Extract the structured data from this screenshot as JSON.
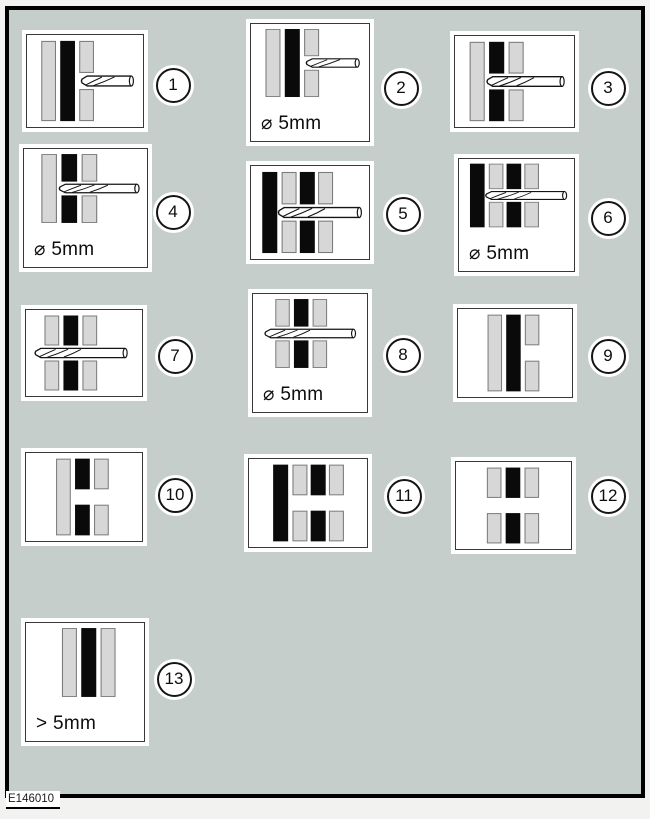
{
  "figure": {
    "code": "E146010"
  },
  "colors": {
    "background": "#c6cecb",
    "frame": "#000000",
    "panel_bg": "#ffffff",
    "bar_gray": "#d7d7d7",
    "bar_gray_outline": "#7c7c7c",
    "bar_black": "#0a0a0a",
    "line": "#141414"
  },
  "panels": [
    {
      "number": "1",
      "label": "",
      "bars": [
        {
          "tone": "gray",
          "split": false
        },
        {
          "tone": "black",
          "split": false
        },
        {
          "tone": "gray",
          "split": true
        }
      ],
      "drill": "into-outer-sheet"
    },
    {
      "number": "2",
      "label": "⌀ 5mm",
      "bars": [
        {
          "tone": "gray",
          "split": false
        },
        {
          "tone": "black",
          "split": false
        },
        {
          "tone": "gray",
          "split": true
        }
      ],
      "drill": "into-outer-sheet"
    },
    {
      "number": "3",
      "label": "",
      "bars": [
        {
          "tone": "gray",
          "split": false
        },
        {
          "tone": "black",
          "split": true
        },
        {
          "tone": "gray",
          "split": true
        }
      ],
      "drill": "through-two-sheets"
    },
    {
      "number": "4",
      "label": "⌀ 5mm",
      "bars": [
        {
          "tone": "gray",
          "split": false
        },
        {
          "tone": "black",
          "split": true
        },
        {
          "tone": "gray",
          "split": true
        }
      ],
      "drill": "through-two-sheets"
    },
    {
      "number": "5",
      "label": "",
      "bars": [
        {
          "tone": "black",
          "split": false
        },
        {
          "tone": "gray",
          "split": true
        },
        {
          "tone": "black",
          "split": true
        },
        {
          "tone": "gray",
          "split": true
        }
      ],
      "drill": "through-three-sheets"
    },
    {
      "number": "6",
      "label": "⌀ 5mm",
      "bars": [
        {
          "tone": "black",
          "split": false
        },
        {
          "tone": "gray",
          "split": true
        },
        {
          "tone": "black",
          "split": true
        },
        {
          "tone": "gray",
          "split": true
        }
      ],
      "drill": "through-three-sheets"
    },
    {
      "number": "7",
      "label": "",
      "bars": [
        {
          "tone": "gray",
          "split": true
        },
        {
          "tone": "black",
          "split": true
        },
        {
          "tone": "gray",
          "split": true
        }
      ],
      "drill": "through-all-sheets"
    },
    {
      "number": "8",
      "label": "⌀ 5mm",
      "bars": [
        {
          "tone": "gray",
          "split": true
        },
        {
          "tone": "black",
          "split": true
        },
        {
          "tone": "gray",
          "split": true
        }
      ],
      "drill": "through-all-sheets"
    },
    {
      "number": "9",
      "label": "",
      "bars": [
        {
          "tone": "gray",
          "split": false
        },
        {
          "tone": "black",
          "split": false
        },
        {
          "tone": "gray",
          "split": true
        }
      ],
      "drill": null
    },
    {
      "number": "10",
      "label": "",
      "bars": [
        {
          "tone": "gray",
          "split": false
        },
        {
          "tone": "black",
          "split": true
        },
        {
          "tone": "gray",
          "split": true
        }
      ],
      "drill": null
    },
    {
      "number": "11",
      "label": "",
      "bars": [
        {
          "tone": "black",
          "split": false
        },
        {
          "tone": "gray",
          "split": true
        },
        {
          "tone": "black",
          "split": true
        },
        {
          "tone": "gray",
          "split": true
        }
      ],
      "drill": null
    },
    {
      "number": "12",
      "label": "",
      "bars": [
        {
          "tone": "gray",
          "split": true
        },
        {
          "tone": "black",
          "split": true
        },
        {
          "tone": "gray",
          "split": true
        }
      ],
      "drill": null
    },
    {
      "number": "13",
      "label": "> 5mm",
      "bars": [
        {
          "tone": "gray",
          "split": false
        },
        {
          "tone": "black",
          "split": false
        },
        {
          "tone": "gray",
          "split": false
        }
      ],
      "drill": null
    }
  ]
}
